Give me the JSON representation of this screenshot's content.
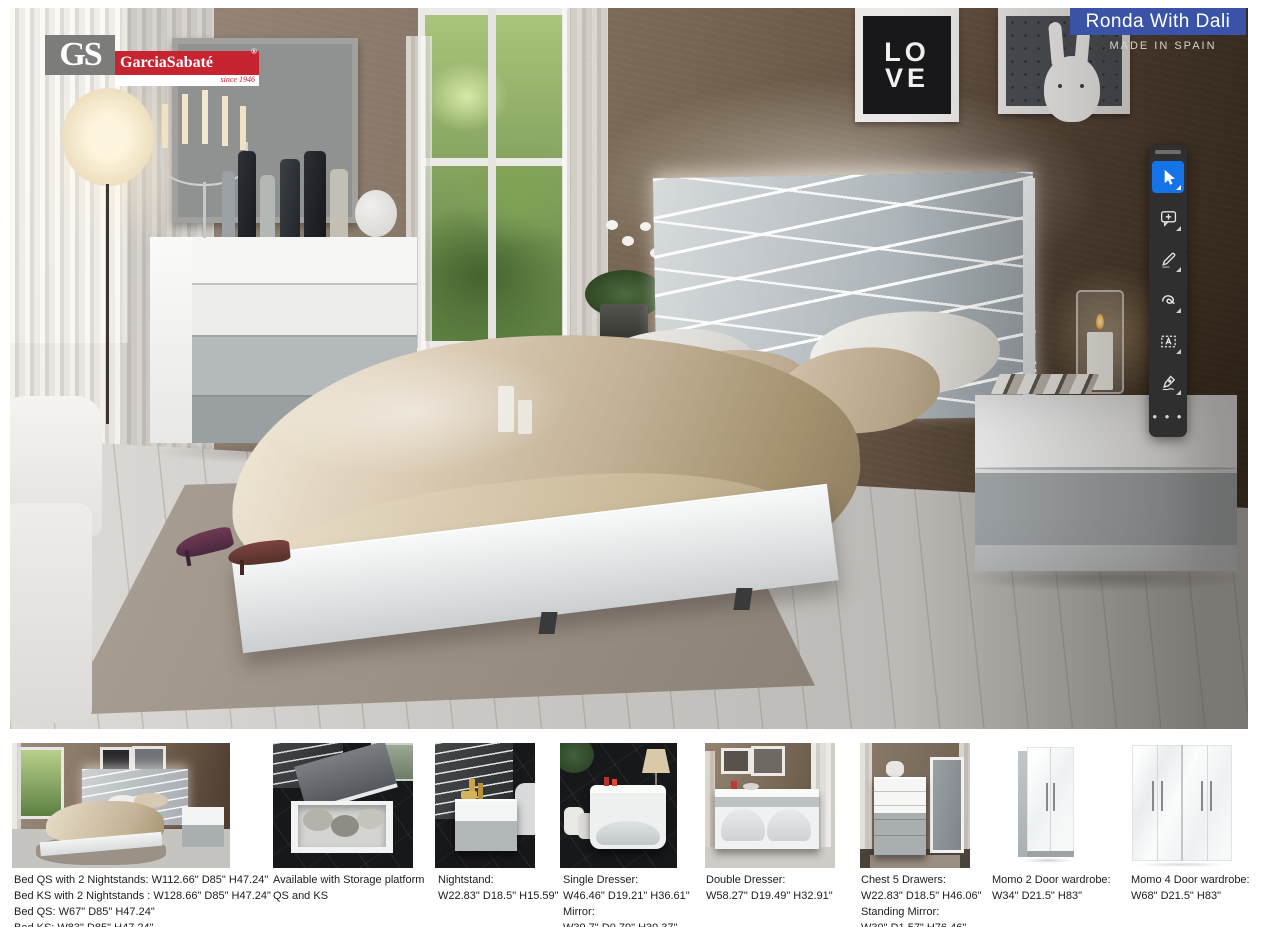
{
  "brand": {
    "initials": "GS",
    "name": "GarciaSabaté",
    "registered": "®",
    "since": "since 1946",
    "gray": "#7c7c7a",
    "red": "#c52430"
  },
  "banner": {
    "title": "Ronda With Dali",
    "made_in": "MADE IN SPAIN",
    "color": "#3a53a6"
  },
  "artworks": {
    "love_line1": "LO",
    "love_line2": "VE"
  },
  "toolbar": {
    "background": "#2f2f2f",
    "active_color": "#1473e6",
    "icon_color": "#e6e6e6",
    "tools": [
      {
        "icon": "select-cursor-icon",
        "active": true
      },
      {
        "icon": "add-comment-icon"
      },
      {
        "icon": "highlight-pencil-icon"
      },
      {
        "icon": "draw-lasso-icon"
      },
      {
        "icon": "text-box-icon"
      },
      {
        "icon": "fill-and-sign-icon"
      },
      {
        "icon": "more-tools-icon"
      }
    ]
  },
  "products": [
    {
      "lines": [
        "Bed QS with 2 Nightstands: W112.66\" D85\" H47.24\"",
        "Bed KS with 2 Nightstands : W128.66\" D85\" H47.24\"",
        "Bed QS: W67\" D85\" H47.24\"",
        "Bed KS: W83\" D85\" H47.24\""
      ]
    },
    {
      "lines": [
        "Available with Storage platform",
        "QS and KS"
      ]
    },
    {
      "lines": [
        "Nightstand:",
        "W22.83\" D18.5\" H15.59\""
      ]
    },
    {
      "lines": [
        "Single Dresser:",
        "W46.46\" D19.21\" H36.61\"",
        "Mirror:",
        "W39.7\" D0.79\" H39.37\""
      ]
    },
    {
      "lines": [
        "Double Dresser:",
        "W58.27\" D19.49\" H32.91\""
      ]
    },
    {
      "lines": [
        "Chest 5 Drawers:",
        "W22.83\" D18.5\" H46.06\"",
        "Standing Mirror:",
        "W30\" D1.57\" H76.46\""
      ]
    },
    {
      "lines": [
        "Momo 2 Door wardrobe:",
        "W34\" D21.5\" H83\""
      ]
    },
    {
      "lines": [
        "Momo 4 Door wardrobe:",
        "W68\" D21.5\" H83\""
      ]
    }
  ]
}
